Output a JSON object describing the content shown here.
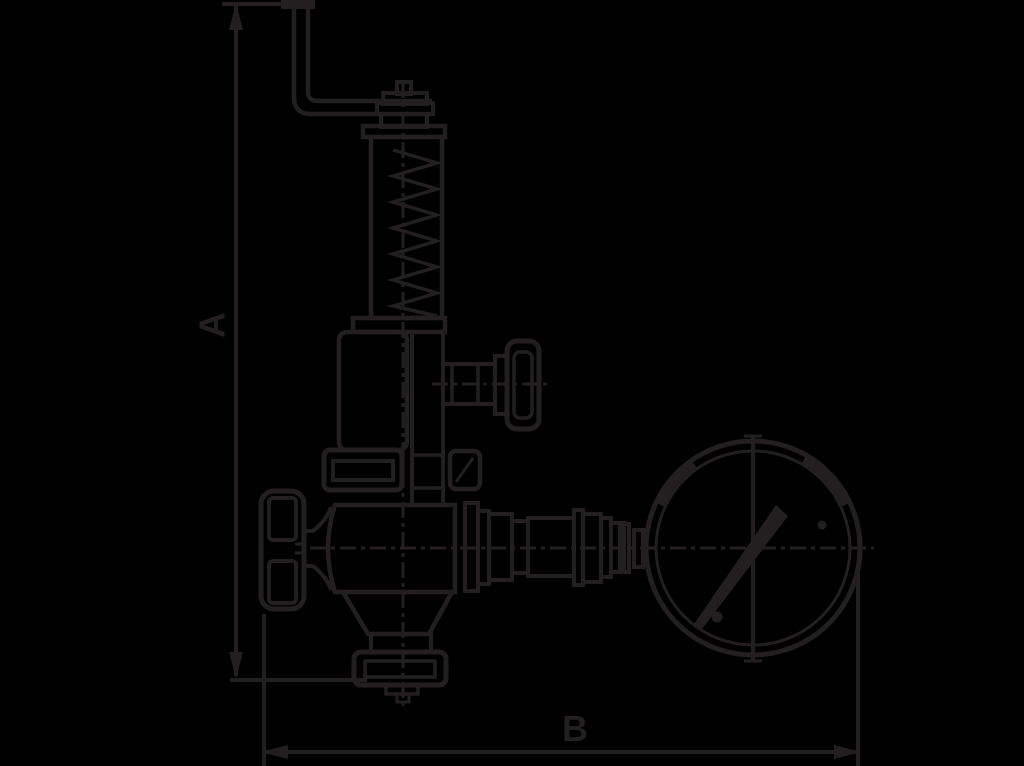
{
  "colors": {
    "background": "#000000",
    "line": "#231f20"
  },
  "diagram": {
    "type": "technical-dimension-drawing",
    "subject": "relief valve with pressure gauge",
    "dim_a": {
      "label": "A",
      "orientation": "vertical"
    },
    "dim_b": {
      "label": "B",
      "orientation": "horizontal"
    }
  },
  "parts": [
    "bent-lever",
    "adjusting-cap",
    "spring-housing",
    "spring-coils",
    "side-handwheel",
    "bonnet-flange",
    "left-handwheel",
    "valve-body",
    "bottom-flange",
    "outlet-piping",
    "pressure-gauge",
    "gauge-needle"
  ]
}
